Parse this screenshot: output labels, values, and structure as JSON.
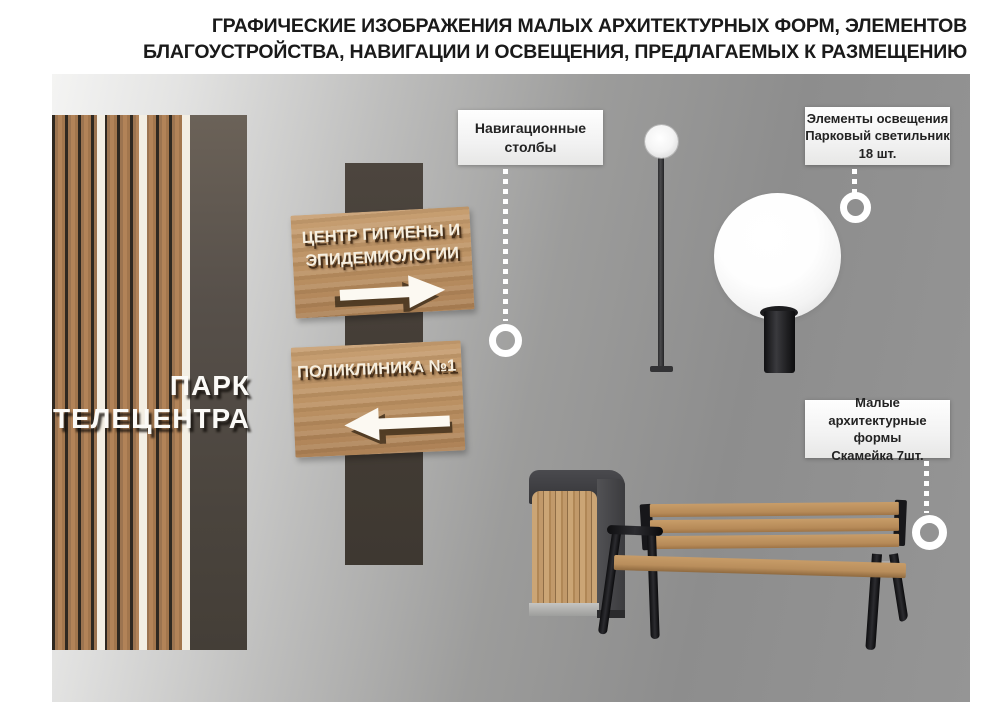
{
  "title": {
    "line1": "ГРАФИЧЕСКИЕ ИЗОБРАЖЕНИЯ МАЛЫХ АРХИТЕКТУРНЫХ ФОРМ, ЭЛЕМЕНТОВ",
    "line2": "БЛАГОУСТРОЙСТВА, НАВИГАЦИИ И ОСВЕЩЕНИЯ, ПРЕДЛАГАЕМЫХ К РАЗМЕЩЕНИЮ"
  },
  "wall_sign": {
    "line1": "ПАРК",
    "line2": "ТЕЛЕЦЕНТРА"
  },
  "nav_signs": {
    "sign1": {
      "line1": "ЦЕНТР ГИГИЕНЫ И",
      "line2": "ЭПИДЕМИОЛОГИИ",
      "direction": "right"
    },
    "sign2": {
      "line1": "ПОЛИКЛИНИКА №1",
      "direction": "left"
    }
  },
  "callouts": {
    "navigation": {
      "line1": "Навигационные",
      "line2": "столбы"
    },
    "lighting": {
      "line1": "Элементы освещения",
      "line2": "Парковый светильник",
      "line3": "18 шт."
    },
    "maf": {
      "line1": "Малые архитектурные",
      "line2": "формы",
      "line3": "Скамейка 7шт."
    }
  },
  "colors": {
    "panel_gray": "#8f8f8f",
    "wood": "#b98c5e",
    "wall_dark": "#4a433c",
    "frame_black": "#1a1a1c",
    "callout_bg": "#f4f4f4",
    "title_text": "#1a1a1a",
    "marker_white": "#ffffff"
  }
}
